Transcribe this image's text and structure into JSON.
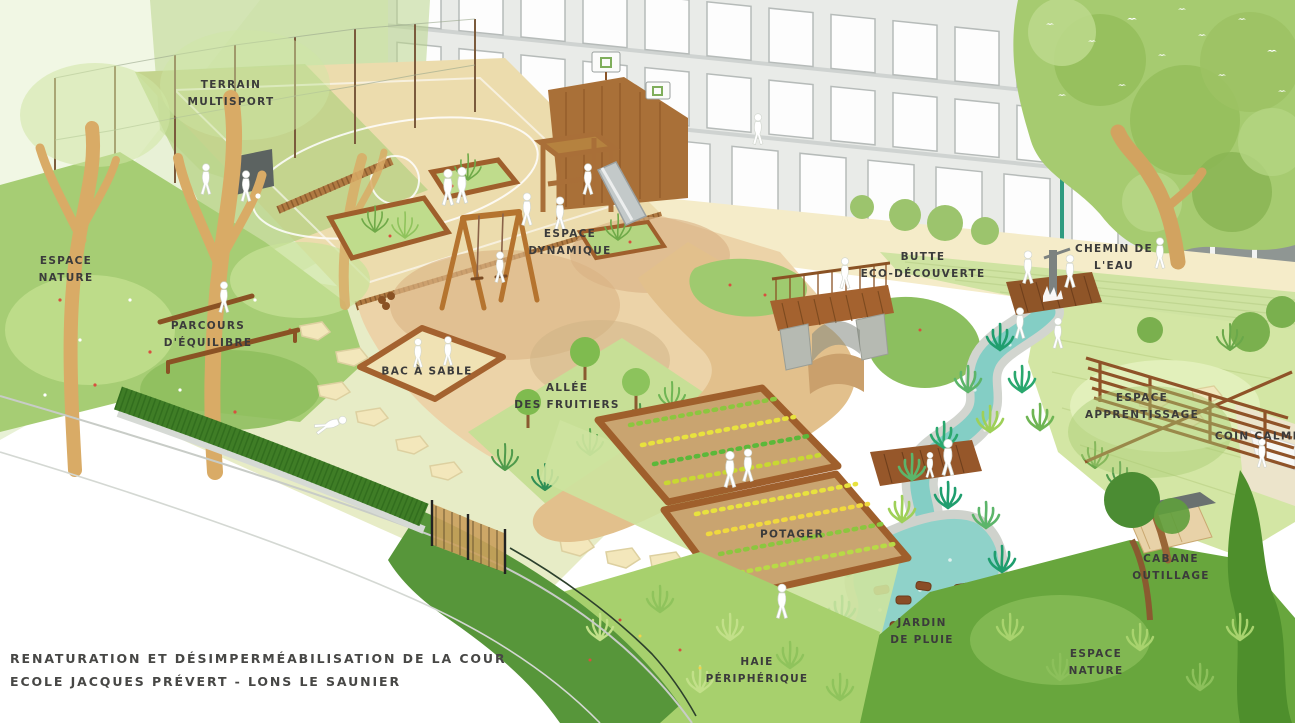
{
  "title": {
    "line1": "RENATURATION ET DÉSIMPERMÉABILISATION DE LA COUR",
    "line2": "ECOLE JACQUES PRÉVERT - LONS LE SAUNIER"
  },
  "zones": {
    "terrain_multisport": {
      "l1": "TERRAIN",
      "l2": "MULTISPORT"
    },
    "espace_nature_left": {
      "l1": "ESPACE",
      "l2": "NATURE"
    },
    "parcours_equilibre": {
      "l1": "PARCOURS",
      "l2": "D'ÉQUILIBRE"
    },
    "espace_dynamique": {
      "l1": "ESPACE",
      "l2": "DYNAMIQUE"
    },
    "bac_a_sable": {
      "l1": "BAC À SABLE"
    },
    "allee_des_fruitiers": {
      "l1": "ALLÉE",
      "l2": "DES FRUITIERS"
    },
    "butte_eco_decouverte": {
      "l1": "BUTTE",
      "l2": "ECO-DÉCOUVERTE"
    },
    "chemin_de_l_eau": {
      "l1": "CHEMIN DE",
      "l2": "L'EAU"
    },
    "espace_apprentissage": {
      "l1": "ESPACE",
      "l2": "APPRENTISSAGE"
    },
    "coin_calme": {
      "l1": "COIN CALME"
    },
    "cabane_outillage": {
      "l1": "CABANE",
      "l2": "OUTILLAGE"
    },
    "jardin_de_pluie": {
      "l1": "JARDIN",
      "l2": "DE PLUIE"
    },
    "potager": {
      "l1": "POTAGER"
    },
    "haie_peripherique": {
      "l1": "HAIE",
      "l2": "PÉRIPHÉRIQUE"
    },
    "espace_nature_right": {
      "l1": "ESPACE",
      "l2": "NATURE"
    }
  },
  "palette": {
    "label_ink": "#3b3b3b",
    "title_ink": "#474745",
    "building_wall": "#e9ebe8",
    "window_white": "#fdfdfd",
    "wood_brown": "#a4622f",
    "water_teal": "#84cec5",
    "pipe_teal": "#2f9b80",
    "sand_beige": "#f0e2b4",
    "path_tan": "#e2c08c",
    "lawn_light": "#d3e6a4",
    "lawn_mid": "#a6cd74",
    "hedge_dark": "#3f7d26",
    "gravel_grey": "#d2d5cf"
  }
}
